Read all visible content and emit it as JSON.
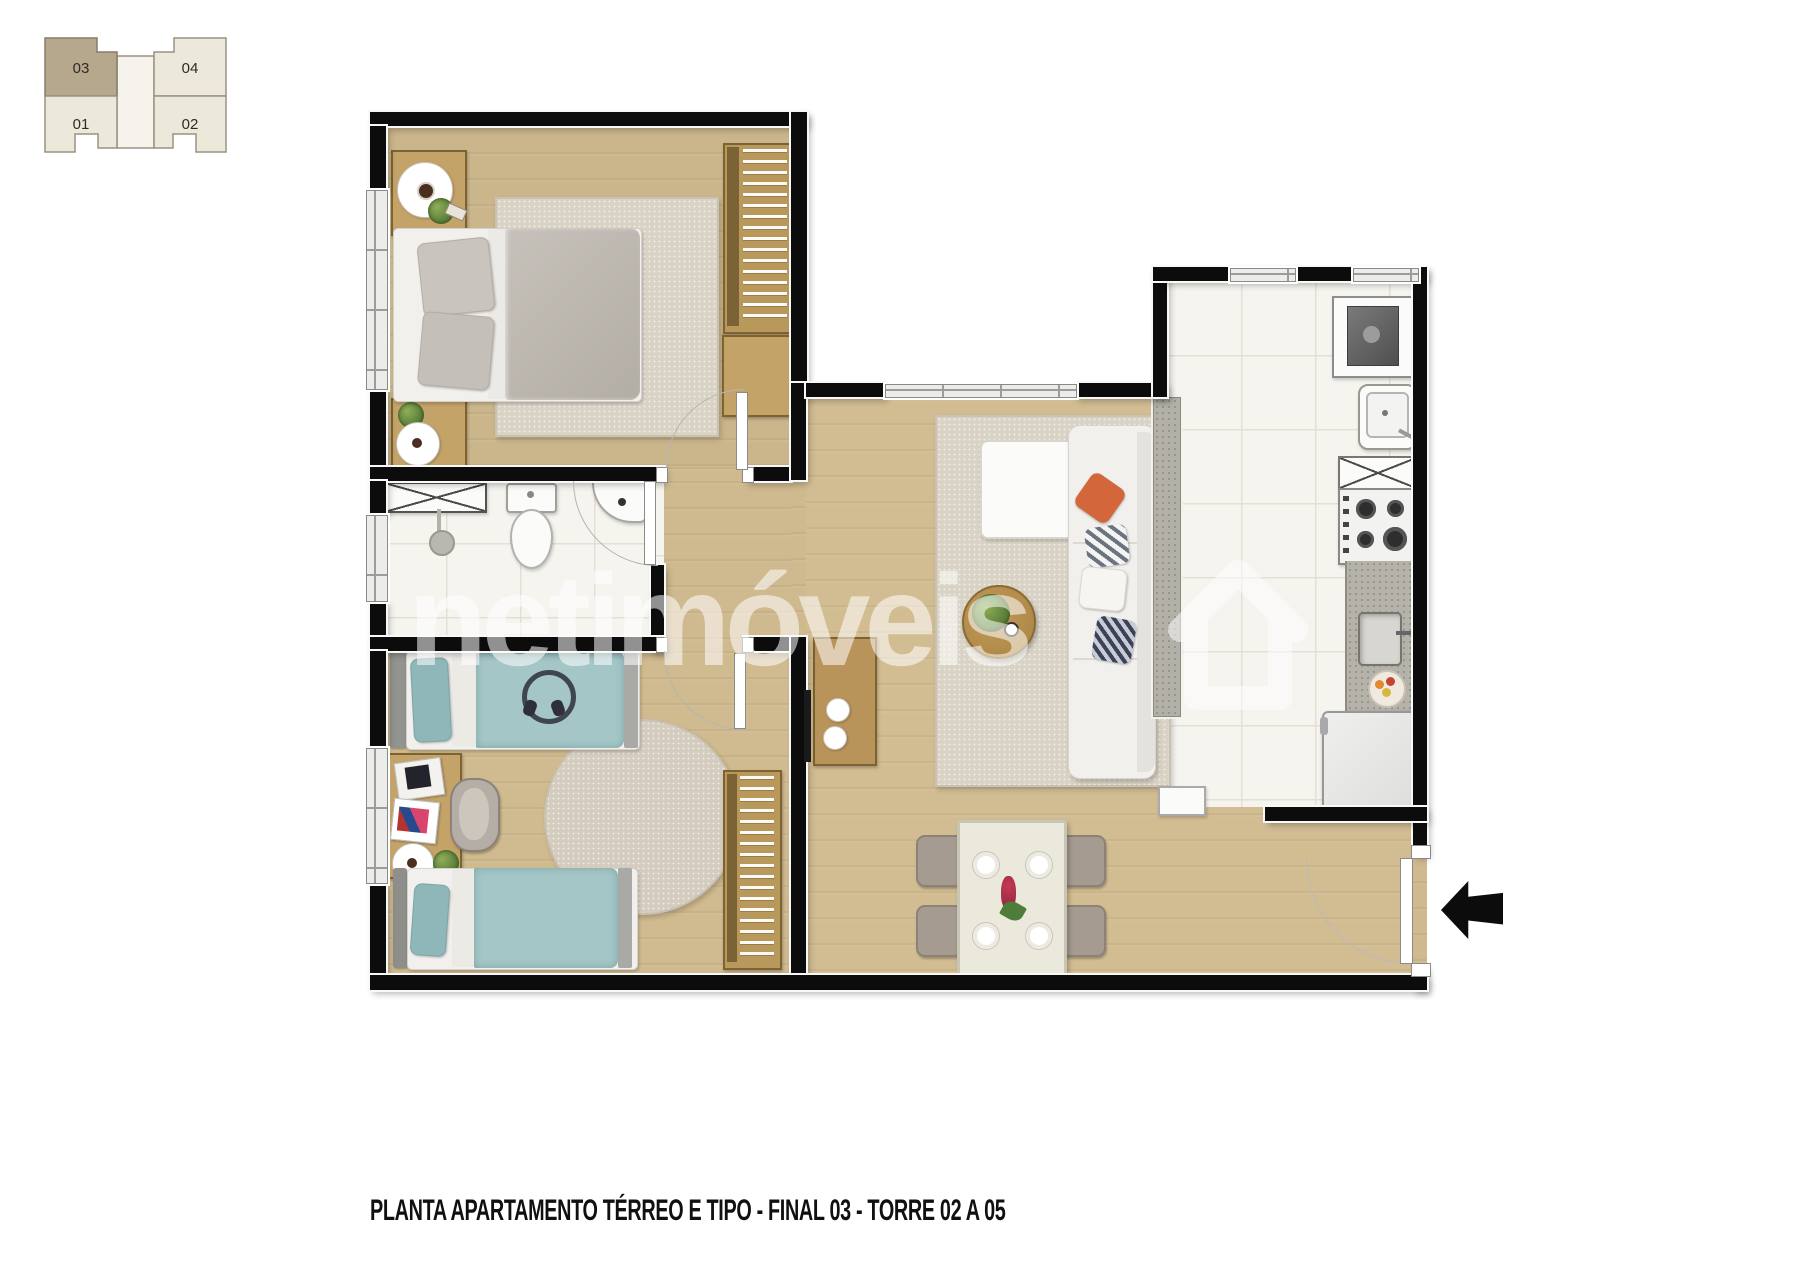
{
  "page": {
    "caption": "PLANTA APARTAMENTO TÉRREO E TIPO - FINAL 03 - TORRE 02 A 05",
    "watermark": "netimóveis"
  },
  "key_plan": {
    "units": [
      {
        "label": "03",
        "highlighted": true
      },
      {
        "label": "04",
        "highlighted": false
      },
      {
        "label": "01",
        "highlighted": false
      },
      {
        "label": "02",
        "highlighted": false
      }
    ]
  },
  "colors": {
    "wall": "#0c0c0c",
    "wood_floor": "#cfb98f",
    "tile_floor": "#f6f4ef",
    "rug_beige": "#d9d3c5",
    "bed_teal": "#a4c6c7",
    "pillow_orange": "#d4663c",
    "wood_furniture": "#c4a369",
    "unit_highlight_fill": "#b5a88c",
    "unit_fill": "#ece8da"
  }
}
